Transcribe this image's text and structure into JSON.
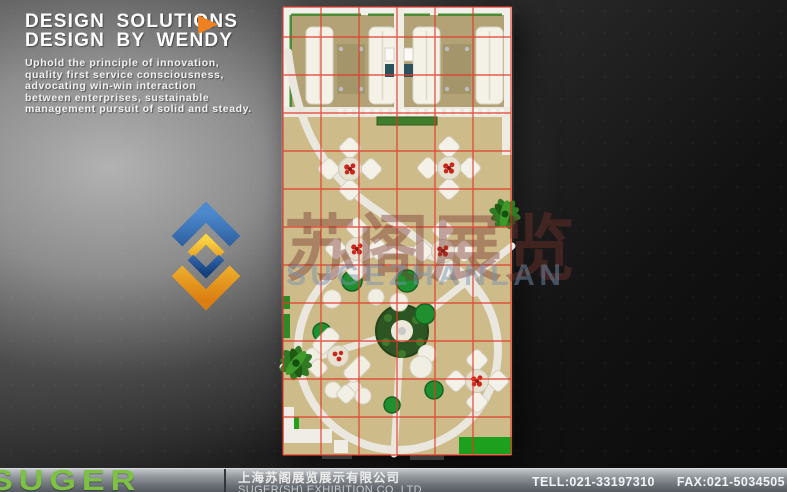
{
  "header": {
    "title_line1": "DESIGN SOLUTIONS",
    "title_line2": "DESIGN BY WENDY",
    "description_lines": [
      "Uphold the principle of innovation,",
      "quality first service consciousness,",
      "advocating win-win interaction",
      "between enterprises, sustainable",
      "management pursuit of solid and steady."
    ]
  },
  "watermark": {
    "cn": "苏阁展览",
    "en": "SUGEZHANLAN"
  },
  "footer": {
    "brand": "SUGER",
    "company_cn": "上海苏阁展览展示有限公司",
    "company_en": "SUGER(SH) EXHIBITION CO.,LTD",
    "tel": "TELL:021-33197310",
    "fax": "FAX:021-5034505"
  },
  "colors": {
    "accent_orange": "#f08122",
    "brand_green": "#7dc242",
    "grid_red": "#e03a28",
    "floor_tan": "#cdbb8a",
    "floor_dark_tan": "#b3a276",
    "wall_white": "#f2f0ea",
    "path_white": "#eae7df",
    "furniture_white": "#f4f1e8",
    "flower_red": "#cc2418",
    "plant_green": "#2f7a22",
    "pouf_green": "#1f8f30",
    "green_block": "#1da01d"
  }
}
